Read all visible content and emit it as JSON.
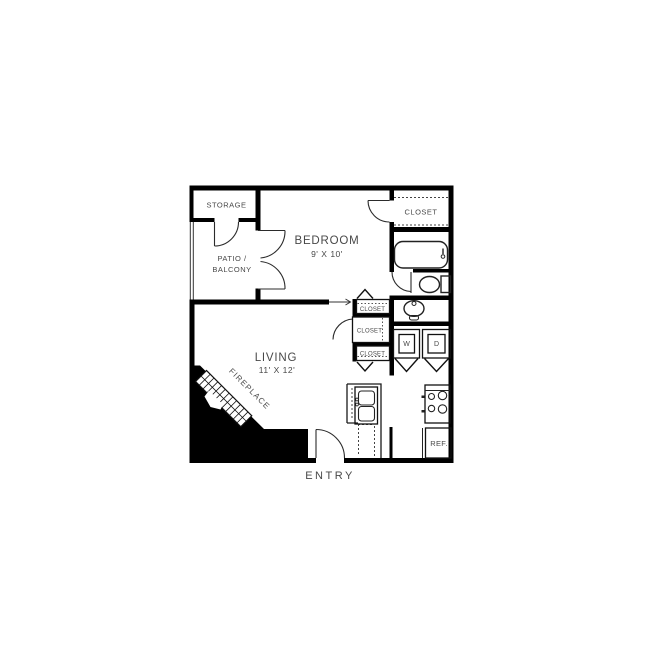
{
  "image_type": "apartment floor plan drawing",
  "colors": {
    "background": "#ffffff",
    "walls": "#000000",
    "label_text": "#484848",
    "fixture_lines": "#222222"
  },
  "rooms": {
    "storage": {
      "label": "STORAGE"
    },
    "patio_balcony": {
      "label_line1": "PATIO /",
      "label_line2": "BALCONY"
    },
    "bedroom": {
      "label": "BEDROOM",
      "dimensions": "9' X 10'"
    },
    "bedroom_closet": {
      "label": "CLOSET"
    },
    "living": {
      "label": "LIVING",
      "dimensions": "11' X 12'"
    },
    "hall_closet_top": {
      "label": "CLOSET"
    },
    "hall_closet_middle": {
      "label": "CLOSET"
    },
    "hall_closet_bottom": {
      "label": "CLOSET"
    },
    "fireplace": {
      "label": "FIREPLACE"
    },
    "laundry": {
      "washer_label": "W",
      "dryer_label": "D"
    },
    "kitchen": {
      "refrigerator_label": "REF."
    },
    "entry": {
      "label": "ENTRY"
    }
  },
  "fixtures": {
    "bathroom": [
      "bathtub",
      "toilet",
      "pedestal-sink"
    ],
    "kitchen": [
      "double-sink",
      "stove-4-burner",
      "refrigerator"
    ],
    "laundry": [
      "washer",
      "dryer"
    ]
  }
}
